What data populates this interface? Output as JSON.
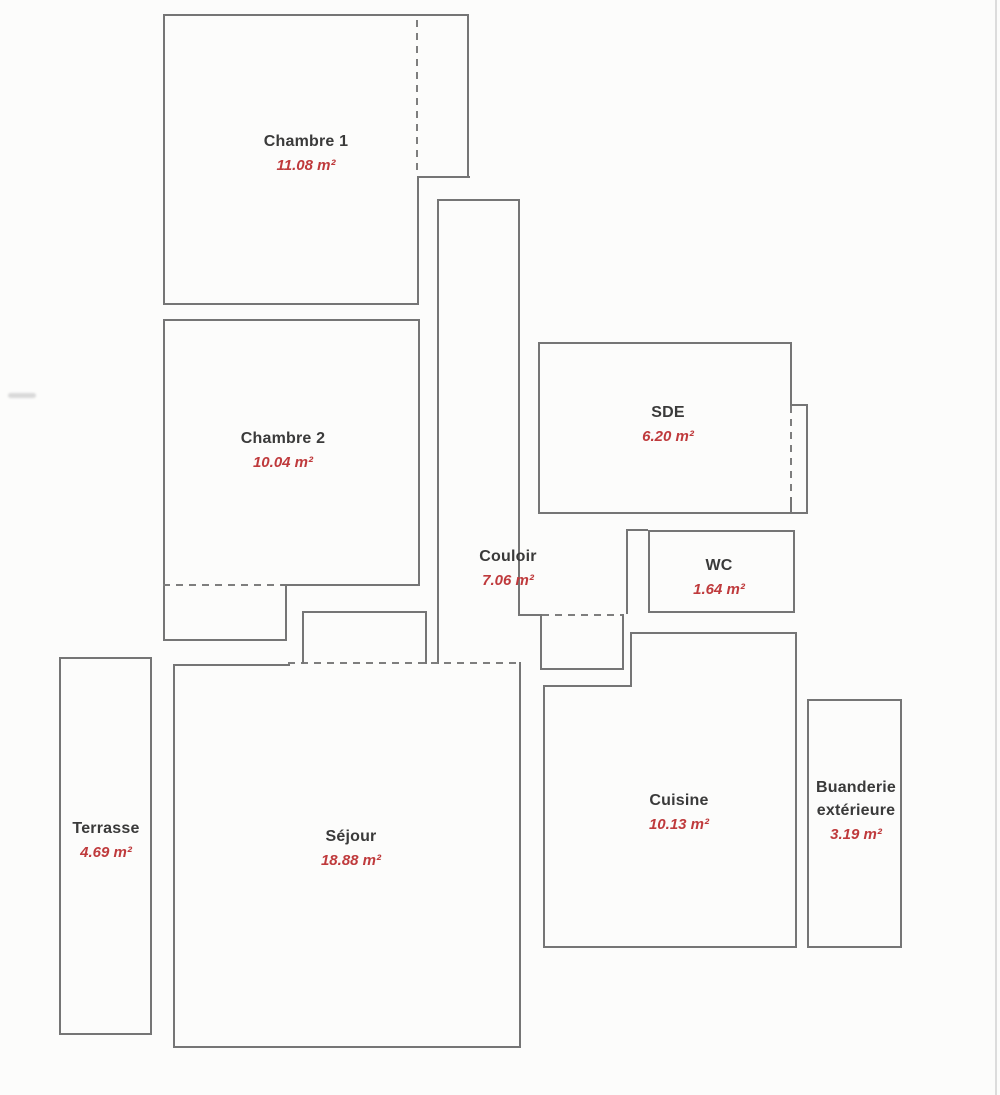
{
  "plan_title": "Floor plan",
  "rooms": [
    {
      "name": "Chambre 1",
      "area": "11.08 m²"
    },
    {
      "name": "Chambre 2",
      "area": "10.04 m²"
    },
    {
      "name": "SDE",
      "area": "6.20 m²"
    },
    {
      "name": "Couloir",
      "area": "7.06 m²"
    },
    {
      "name": "WC",
      "area": "1.64 m²"
    },
    {
      "name": "Cuisine",
      "area": "10.13 m²"
    },
    {
      "name": "Séjour",
      "area": "18.88 m²"
    },
    {
      "name": "Terrasse",
      "area": "4.69 m²"
    },
    {
      "name": "Buanderie extérieure",
      "area": "3.19 m²"
    }
  ],
  "colors": {
    "wall": "#757575",
    "label_text": "#3a3a3a",
    "area_text": "#bf3a3c",
    "background": "#fcfcfb"
  }
}
